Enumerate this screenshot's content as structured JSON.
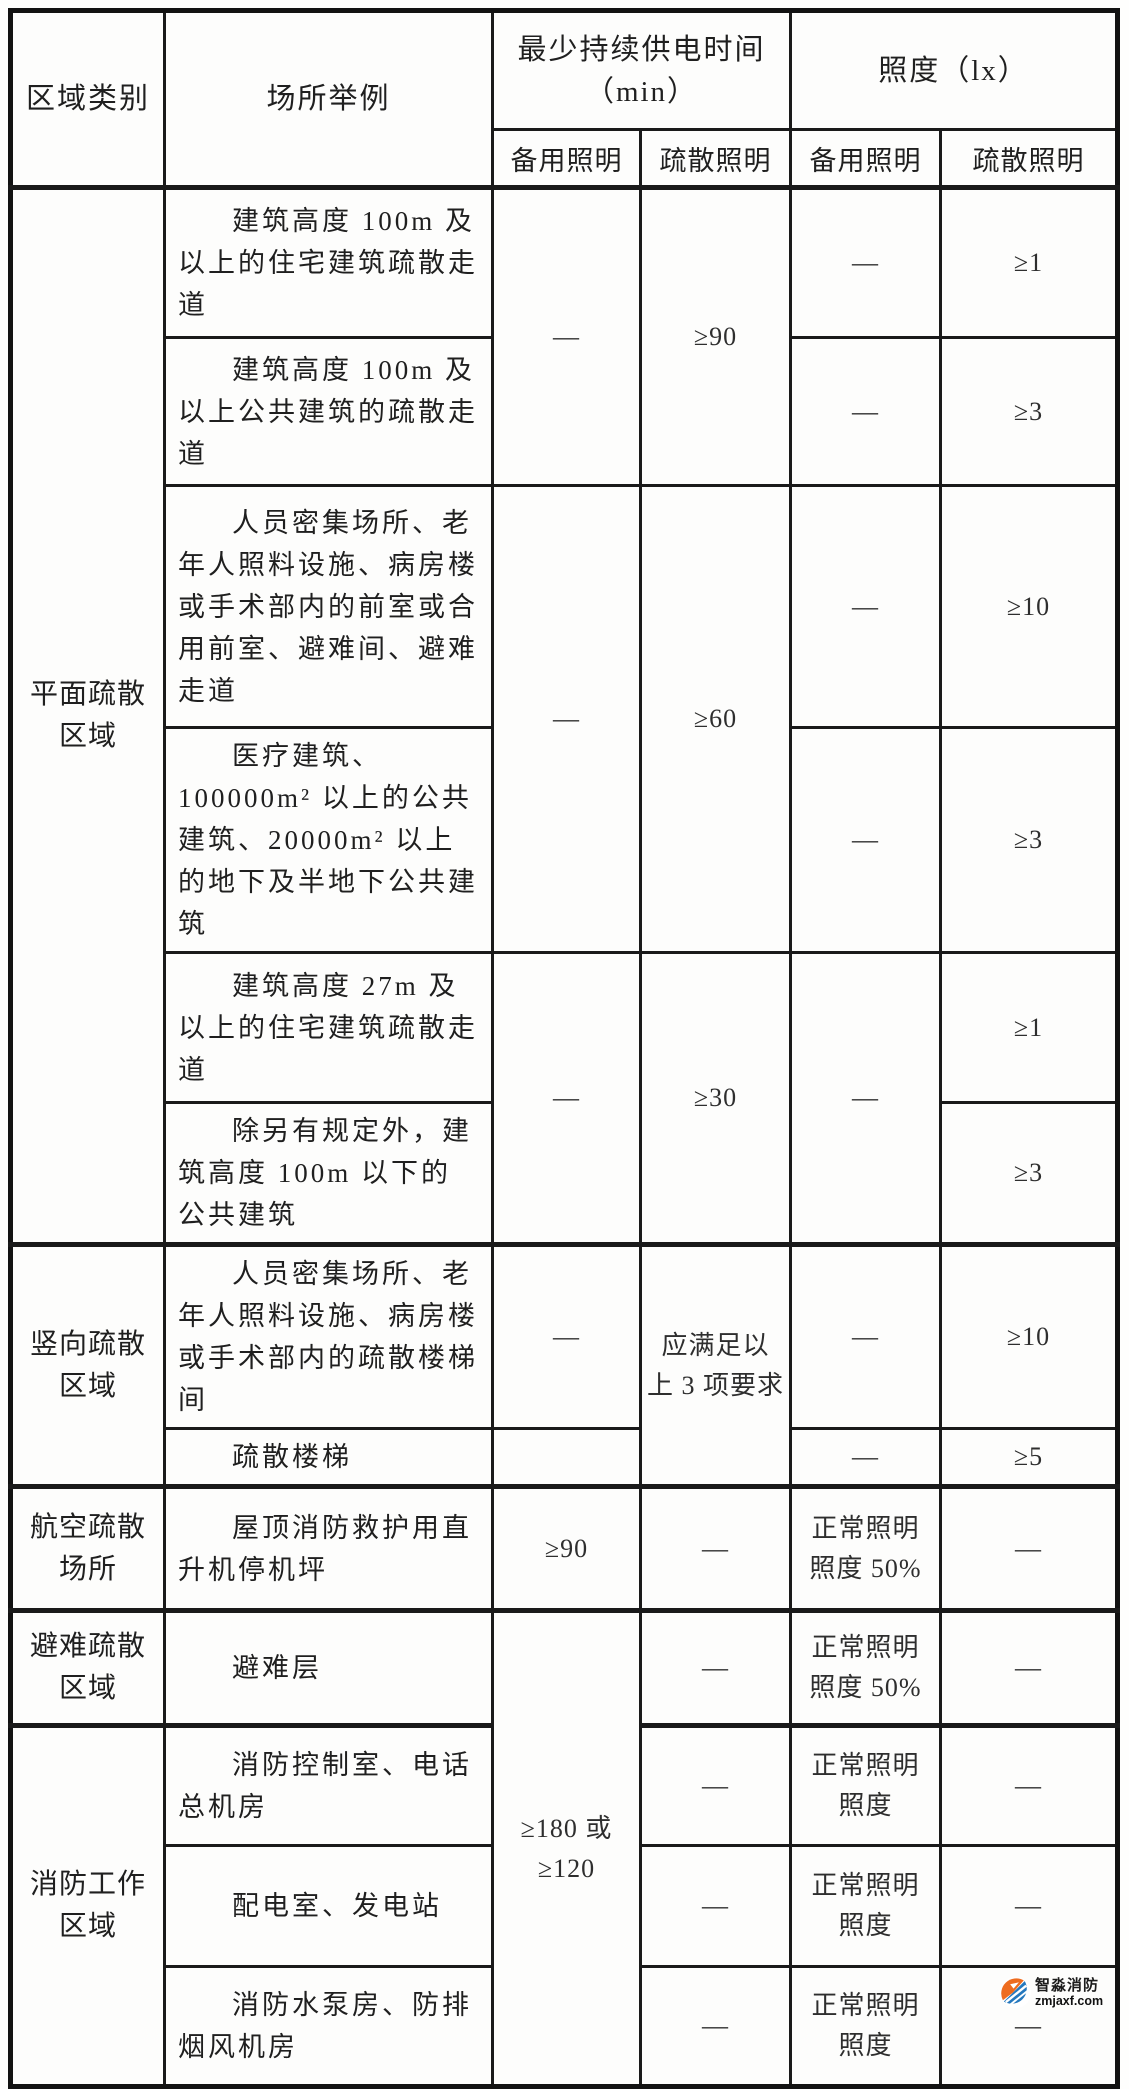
{
  "table": {
    "header": {
      "area": "区域类别",
      "place": "场所举例",
      "time_group": "最少持续供电时间\n（min）",
      "lux_group": "照度（lx）",
      "time_backup": "备用照明",
      "time_evac": "疏散照明",
      "lux_backup": "备用照明",
      "lux_evac": "疏散照明"
    },
    "areas": {
      "plane": "平面疏散\n区域",
      "vertical": "竖向疏散\n区域",
      "aviation": "航空疏散\n场所",
      "refuge": "避难疏散\n区域",
      "fire_work": "消防工作\n区域"
    },
    "rows": {
      "r1": {
        "place": "建筑高度 100m 及以上的住宅建筑疏散走道",
        "lux_backup": "—",
        "lux_evac": "≥1"
      },
      "r1_2": {
        "min_backup": "—",
        "min_evac": "≥90"
      },
      "r2": {
        "place": "建筑高度 100m 及以上公共建筑的疏散走道",
        "lux_backup": "—",
        "lux_evac": "≥3"
      },
      "r3": {
        "place": "人员密集场所、老年人照料设施、病房楼或手术部内的前室或合用前室、避难间、避难走道",
        "lux_backup": "—",
        "lux_evac": "≥10"
      },
      "r3_4": {
        "min_backup": "—",
        "min_evac": "≥60"
      },
      "r4": {
        "place": "医疗建筑、100000m² 以上的公共建筑、20000m² 以上的地下及半地下公共建筑",
        "lux_backup": "—",
        "lux_evac": "≥3"
      },
      "r5": {
        "place": "建筑高度 27m 及以上的住宅建筑疏散走道",
        "lux_evac": "≥1"
      },
      "r5_6": {
        "min_backup": "—",
        "min_evac": "≥30",
        "lux_backup": "—"
      },
      "r6": {
        "place": "除另有规定外，建筑高度 100m 以下的公共建筑",
        "lux_evac": "≥3"
      },
      "r7": {
        "place": "人员密集场所、老年人照料设施、病房楼或手术部内的疏散楼梯间",
        "min_backup": "—",
        "lux_backup": "—",
        "lux_evac": "≥10"
      },
      "r7_8": {
        "min_evac": "应满足以\n上 3 项要求"
      },
      "r8": {
        "place": "疏散楼梯",
        "min_backup": "",
        "lux_backup": "—",
        "lux_evac": "≥5"
      },
      "r9": {
        "place": "屋顶消防救护用直升机停机坪",
        "min_backup": "≥90",
        "min_evac": "—",
        "lux_backup": "正常照明\n照度 50%",
        "lux_evac": "—"
      },
      "r10": {
        "place": "避难层",
        "min_evac": "—",
        "lux_backup": "正常照明\n照度 50%",
        "lux_evac": "—"
      },
      "r10_13": {
        "min_backup": "≥180 或\n≥120"
      },
      "r11": {
        "place": "消防控制室、电话总机房",
        "min_evac": "—",
        "lux_backup": "正常照明\n照度",
        "lux_evac": "—"
      },
      "r12": {
        "place": "配电室、发电站",
        "min_evac": "—",
        "lux_backup": "正常照明\n照度",
        "lux_evac": "—"
      },
      "r13": {
        "place": "消防水泵房、防排烟风机房",
        "min_evac": "—",
        "lux_backup": "正常照明\n照度",
        "lux_evac": "—"
      }
    }
  },
  "watermark": {
    "brand": "智淼消防",
    "site": "zmjaxf.com"
  },
  "colors": {
    "border": "#1a1a1a",
    "watermark_orange": "#ee6c1f",
    "watermark_blue": "#2478be"
  }
}
